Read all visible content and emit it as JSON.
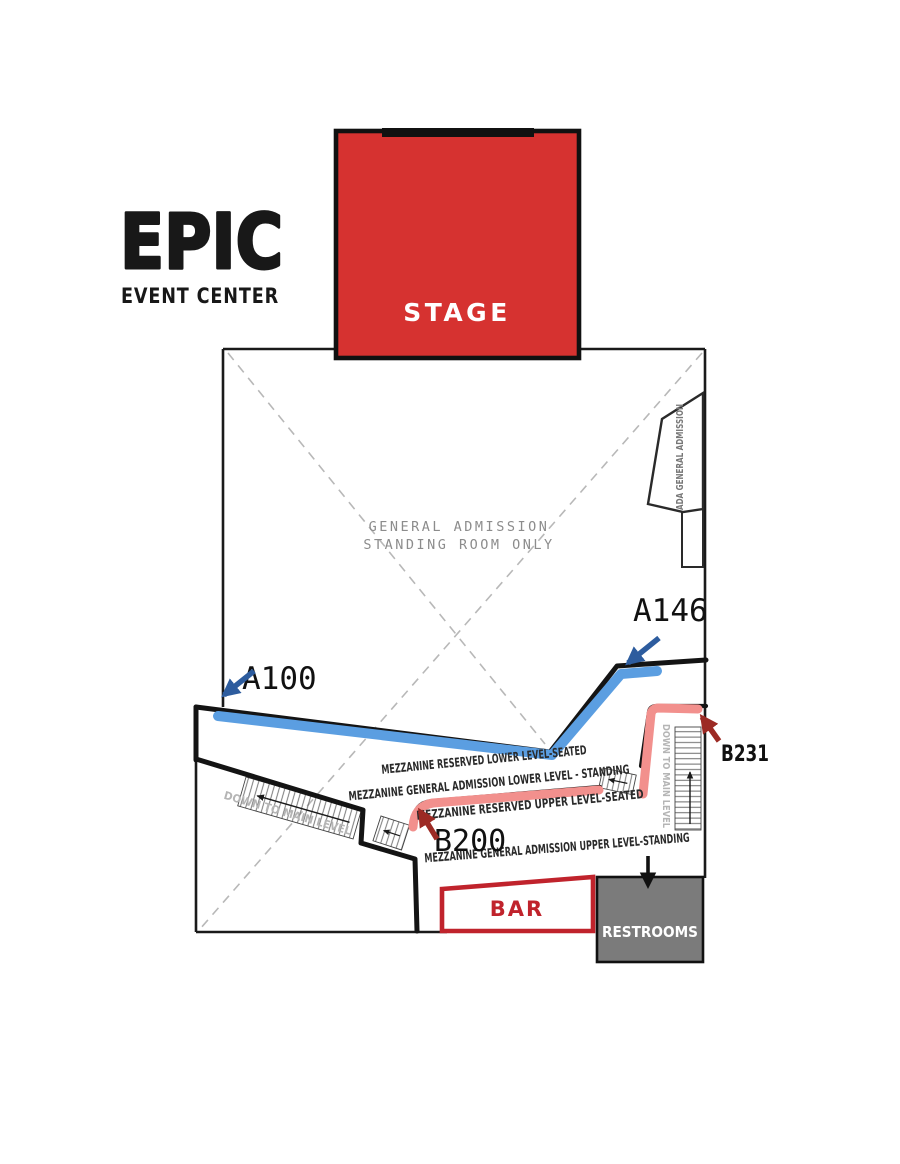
{
  "brand": {
    "logo": "EPIC",
    "tagline": "EVENT CENTER"
  },
  "stage": {
    "label": "STAGE"
  },
  "floor": {
    "ga_line1": "GENERAL ADMISSION",
    "ga_line2": "STANDING ROOM ONLY"
  },
  "ada": {
    "label": "ADA GENERAL ADMISSION"
  },
  "seat_markers": {
    "a100": "A100",
    "a146": "A146",
    "b200": "B200",
    "b231": "B231"
  },
  "mezzanine": {
    "reserved_lower": "MEZZANINE RESERVED LOWER LEVEL-SEATED",
    "ga_lower": "MEZZANINE GENERAL ADMISSION LOWER LEVEL - STANDING",
    "reserved_upper": "MEZZANINE RESERVED UPPER LEVEL-SEATED",
    "ga_upper": "MEZZANINE GENERAL ADMISSION UPPER LEVEL-STANDING"
  },
  "stairs": {
    "down_left": "DOWN TO MAIN LEVEL",
    "down_right": "DOWN TO MAIN LEVEL"
  },
  "amenities": {
    "bar": "BAR",
    "restrooms": "RESTROOMS"
  },
  "colors": {
    "stage_red": "#d63230",
    "bar_red": "#c0232c",
    "row_a_blue": "#5b9ee1",
    "row_b_pink": "#f2908d",
    "arrow_blue": "#2d5c9e",
    "arrow_dark_red": "#9c2a24",
    "restroom_gray": "#7b7b7b"
  }
}
